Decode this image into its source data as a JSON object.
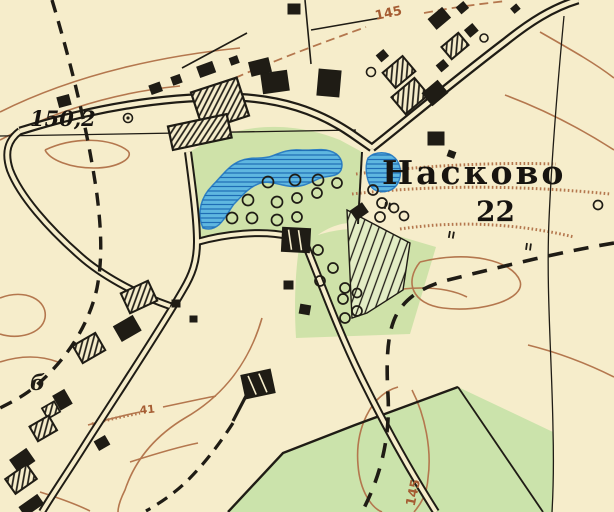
{
  "map": {
    "settlement_label": "Насково",
    "settlement_count": "22",
    "elevation_point_value": "150,2",
    "contour_label_top": "145",
    "contour_label_bottom": "145",
    "contour_label_small": "41",
    "building_annotation": "б"
  },
  "symbols": {
    "elevation-point-icon": "circle-with-dot",
    "orchard-tree-icon": "small-circle",
    "meadow-icon": "double-tick",
    "water-hatch-icon": "horizontal-lines",
    "barn-icon": "hatched-rectangle",
    "house-icon": "solid-black-rectangle",
    "boundary-icon": "bold-black-dashes",
    "road-icon": "double-line"
  },
  "colors": {
    "paper": "#f6edcb",
    "vegetation_green": "#cfe2a9",
    "field_green": "#cbe3ab",
    "water_fill": "#5fb7e0",
    "water_lines": "#1e6db5",
    "contour_brown": "#b4774e",
    "contour_text_brown": "#a55c32",
    "ink_black": "#1f1c15"
  }
}
